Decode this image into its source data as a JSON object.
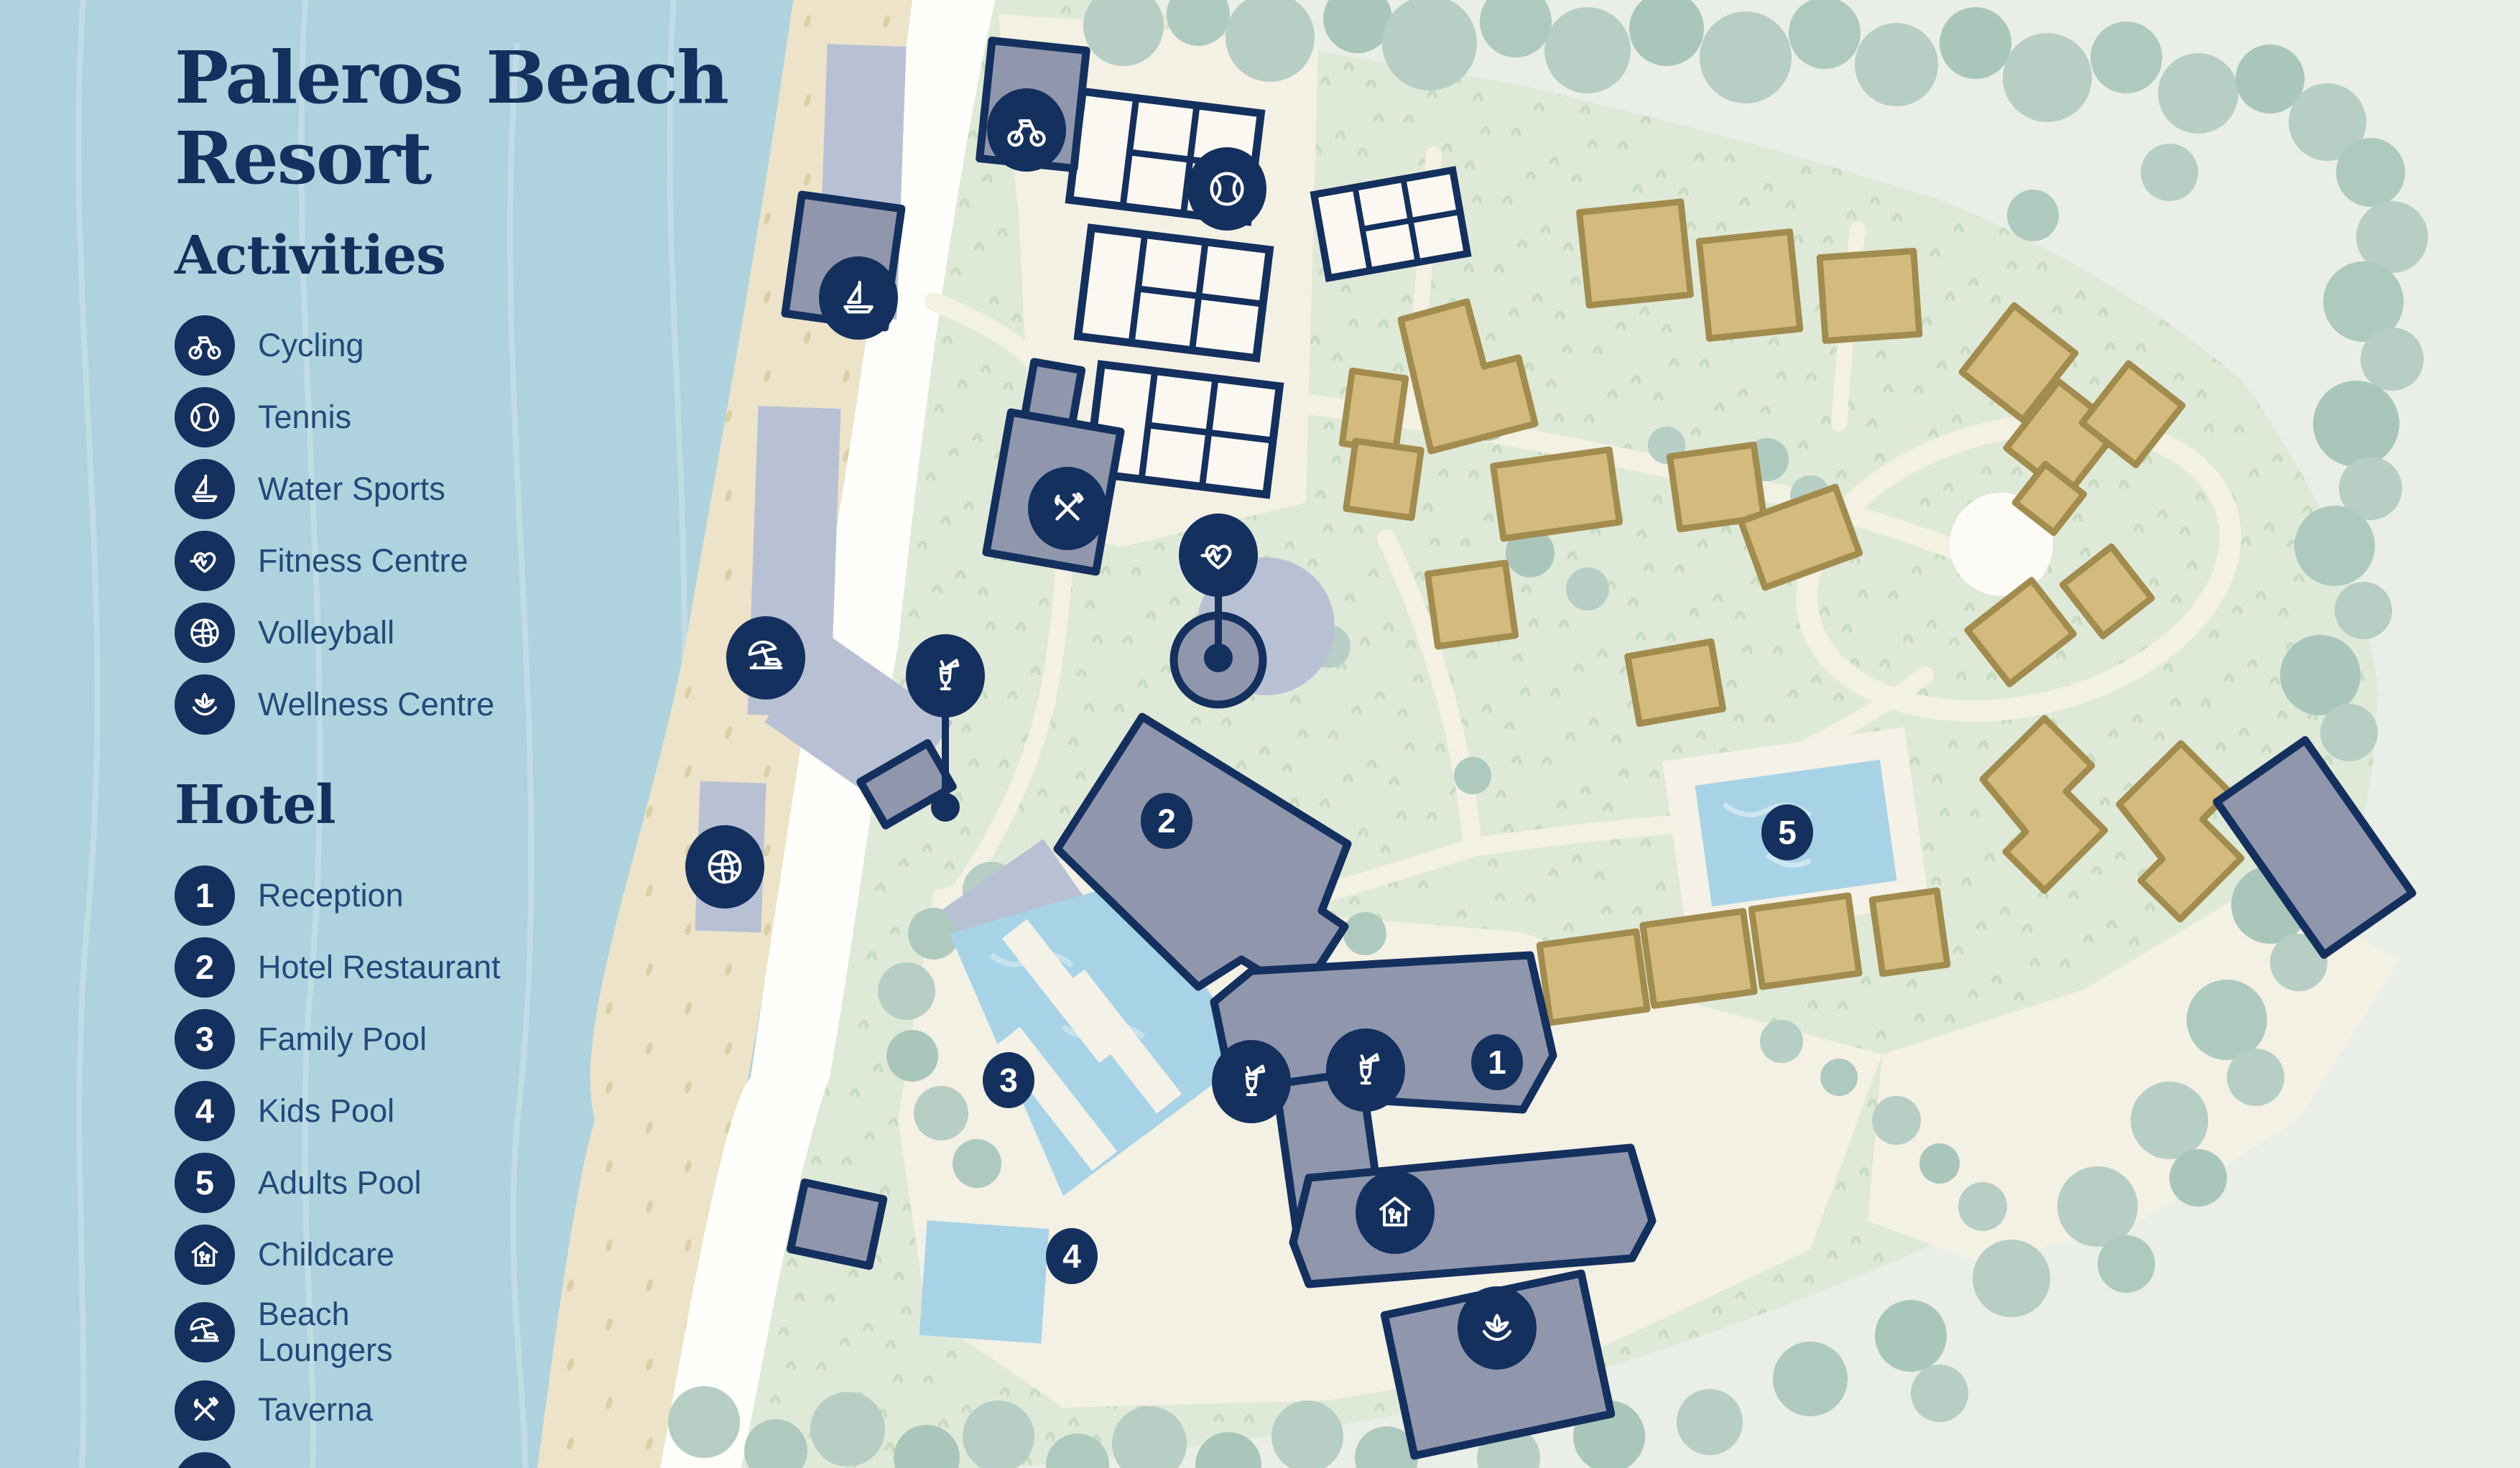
{
  "title": "Paleros Beach Resort",
  "legend": {
    "activities": {
      "heading": "Activities",
      "items": [
        {
          "icon": "cycling-icon",
          "label": "Cycling"
        },
        {
          "icon": "tennis-icon",
          "label": "Tennis"
        },
        {
          "icon": "water-sports-icon",
          "label": "Water Sports"
        },
        {
          "icon": "fitness-icon",
          "label": "Fitness Centre"
        },
        {
          "icon": "volleyball-icon",
          "label": "Volleyball"
        },
        {
          "icon": "wellness-icon",
          "label": "Wellness Centre"
        }
      ]
    },
    "hotel": {
      "heading": "Hotel",
      "items": [
        {
          "num": "1",
          "label": "Reception"
        },
        {
          "num": "2",
          "label": "Hotel Restaurant"
        },
        {
          "num": "3",
          "label": "Family Pool"
        },
        {
          "num": "4",
          "label": "Kids Pool"
        },
        {
          "num": "5",
          "label": "Adults Pool"
        },
        {
          "icon": "childcare-icon",
          "label": "Childcare"
        },
        {
          "icon": "loungers-icon",
          "label": "Beach Loungers"
        },
        {
          "icon": "taverna-icon",
          "label": "Taverna"
        },
        {
          "icon": "bars-icon",
          "label": "Bars"
        }
      ]
    }
  },
  "map": {
    "badges": [
      {
        "number": "1",
        "label": "Reception"
      },
      {
        "number": "2",
        "label": "Hotel Restaurant"
      },
      {
        "number": "3",
        "label": "Family Pool"
      },
      {
        "number": "4",
        "label": "Kids Pool"
      },
      {
        "number": "5",
        "label": "Adults Pool"
      }
    ],
    "markers": [
      {
        "icon": "cycling-icon"
      },
      {
        "icon": "tennis-icon"
      },
      {
        "icon": "water-sports-icon"
      },
      {
        "icon": "taverna-icon"
      },
      {
        "icon": "fitness-icon"
      },
      {
        "icon": "loungers-icon"
      },
      {
        "icon": "bars-icon"
      },
      {
        "icon": "volleyball-icon"
      },
      {
        "icon": "bars-icon"
      },
      {
        "icon": "bars-icon"
      },
      {
        "icon": "childcare-icon"
      },
      {
        "icon": "wellness-icon"
      }
    ]
  },
  "colors": {
    "navy": "#14305e",
    "legend_text": "#23497a",
    "sea": "#aed3de",
    "sand": "#ece3c8",
    "promenade": "#fefefb",
    "grass": "#dfe9d8",
    "plaza": "#f3f0e4",
    "tree": "#b6cec4",
    "building_tan": "#d5ba7d",
    "building_tan_outline": "#a18c4e",
    "building_gray": "#9097ad",
    "building_periwinkle": "#b8c1d4",
    "pool": "#a8d3e7",
    "court_white": "#faf8f1"
  }
}
